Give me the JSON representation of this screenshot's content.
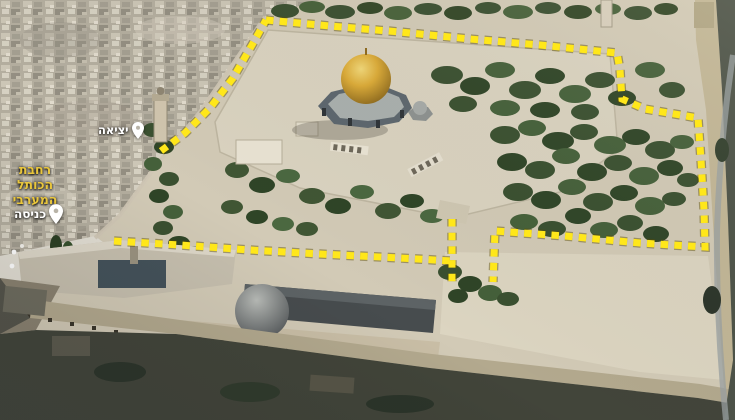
{
  "annotations": {
    "exit": {
      "label": "יציאה",
      "icon": "map-pin-icon"
    },
    "entrance": {
      "label": "כניסה",
      "icon": "map-pin-icon"
    },
    "plaza": {
      "line1": "רחבת",
      "line2": "הכותל",
      "line3": "המערבי"
    },
    "route": {
      "color": "#ffe71a",
      "shadow_color": "rgba(90,75,0,0.45)",
      "style": "dashed"
    },
    "pin_color": "#ffffff"
  }
}
